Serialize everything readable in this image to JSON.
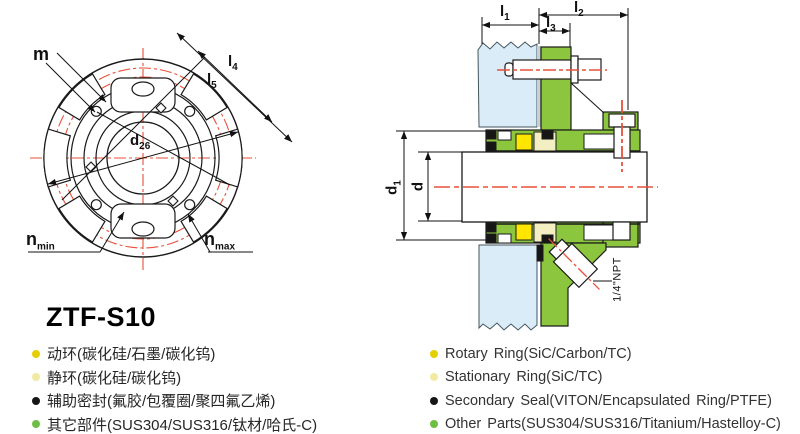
{
  "title": "ZTF-S10",
  "front_view": {
    "labels": {
      "m": {
        "base": "m",
        "sub": ""
      },
      "l4": {
        "base": "l",
        "sub": "4"
      },
      "l5": {
        "base": "l",
        "sub": "5"
      },
      "d26": {
        "base": "d",
        "sub": "26"
      },
      "n_min": {
        "base": "n",
        "sub": "min"
      },
      "n_max": {
        "base": "n",
        "sub": "max"
      }
    }
  },
  "section_view": {
    "labels": {
      "l1": {
        "base": "l",
        "sub": "1"
      },
      "l2": {
        "base": "l",
        "sub": "2"
      },
      "l3": {
        "base": "l",
        "sub": "3"
      },
      "d1": {
        "base": "d",
        "sub": "1"
      },
      "d": {
        "base": "d",
        "sub": ""
      },
      "npt": "1/4\"NPT"
    }
  },
  "legend": {
    "cn": [
      {
        "text": "动环(碳化硅/石墨/碳化钨)",
        "color": "#e6cf00"
      },
      {
        "text": "静环(碳化硅/碳化钨)",
        "color": "#f0eaa2"
      },
      {
        "text": "辅助密封(氟胶/包覆圈/聚四氟乙烯)",
        "color": "#161616"
      },
      {
        "text": "其它部件(SUS304/SUS316/钛材/哈氏-C)",
        "color": "#6fbe44"
      }
    ],
    "en": [
      {
        "text": "Rotary Ring(SiC/Carbon/TC)",
        "color": "#e6cf00"
      },
      {
        "text": "Stationary Ring(SiC/TC)",
        "color": "#f0eaa2"
      },
      {
        "text": "Secondary Seal(VITON/Encapsulated Ring/PTFE)",
        "color": "#161616"
      },
      {
        "text": "Other Parts(SUS304/SUS316/Titanium/Hastelloy-C)",
        "color": "#6fbe44"
      }
    ]
  },
  "colors": {
    "gland_green": "#8cc63e",
    "housing_blue": "#d9ecf7",
    "centerline_red": "#e8503a",
    "spring_yellow": "#ffe600",
    "seat_cream": "#f4efc2"
  }
}
